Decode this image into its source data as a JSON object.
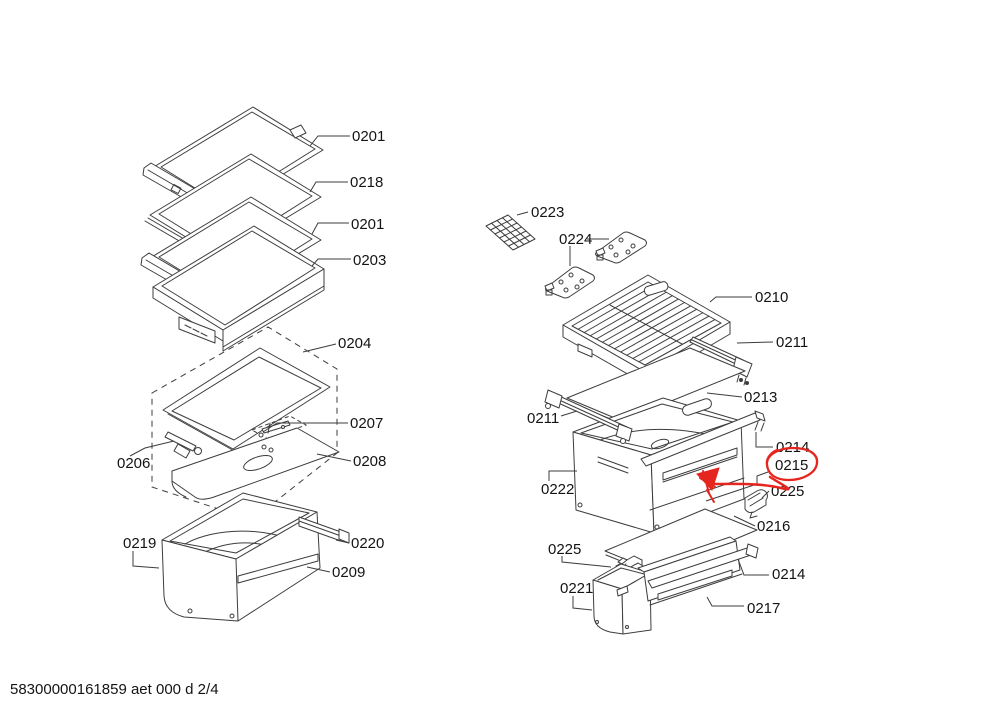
{
  "footer": {
    "text": "58300000161859 aet 000 d 2/4"
  },
  "annotation": {
    "circled_label": "0215",
    "style": "hand-drawn red ellipse with arrow pointing to drawer handle strip",
    "color": "#e5261f"
  },
  "colors": {
    "background": "#ffffff",
    "line": "#3d3d3d",
    "text": "#141414"
  },
  "diagram": {
    "type": "exploded-parts-diagram",
    "labels": [
      {
        "id": "0201-a",
        "text": "0201"
      },
      {
        "id": "0218",
        "text": "0218"
      },
      {
        "id": "0201-b",
        "text": "0201"
      },
      {
        "id": "0203",
        "text": "0203"
      },
      {
        "id": "0204",
        "text": "0204"
      },
      {
        "id": "0207",
        "text": "0207"
      },
      {
        "id": "0206",
        "text": "0206"
      },
      {
        "id": "0208",
        "text": "0208"
      },
      {
        "id": "0219",
        "text": "0219"
      },
      {
        "id": "0220",
        "text": "0220"
      },
      {
        "id": "0209",
        "text": "0209"
      },
      {
        "id": "0223",
        "text": "0223"
      },
      {
        "id": "0224",
        "text": "0224"
      },
      {
        "id": "0210",
        "text": "0210"
      },
      {
        "id": "0211-right",
        "text": "0211"
      },
      {
        "id": "0213",
        "text": "0213"
      },
      {
        "id": "0211-left",
        "text": "0211"
      },
      {
        "id": "0214-upper",
        "text": "0214"
      },
      {
        "id": "0215",
        "text": "0215"
      },
      {
        "id": "0222",
        "text": "0222"
      },
      {
        "id": "0225-upper",
        "text": "0225"
      },
      {
        "id": "0216",
        "text": "0216"
      },
      {
        "id": "0225-lower",
        "text": "0225"
      },
      {
        "id": "0221",
        "text": "0221"
      },
      {
        "id": "0214-lower",
        "text": "0214"
      },
      {
        "id": "0217",
        "text": "0217"
      }
    ]
  }
}
